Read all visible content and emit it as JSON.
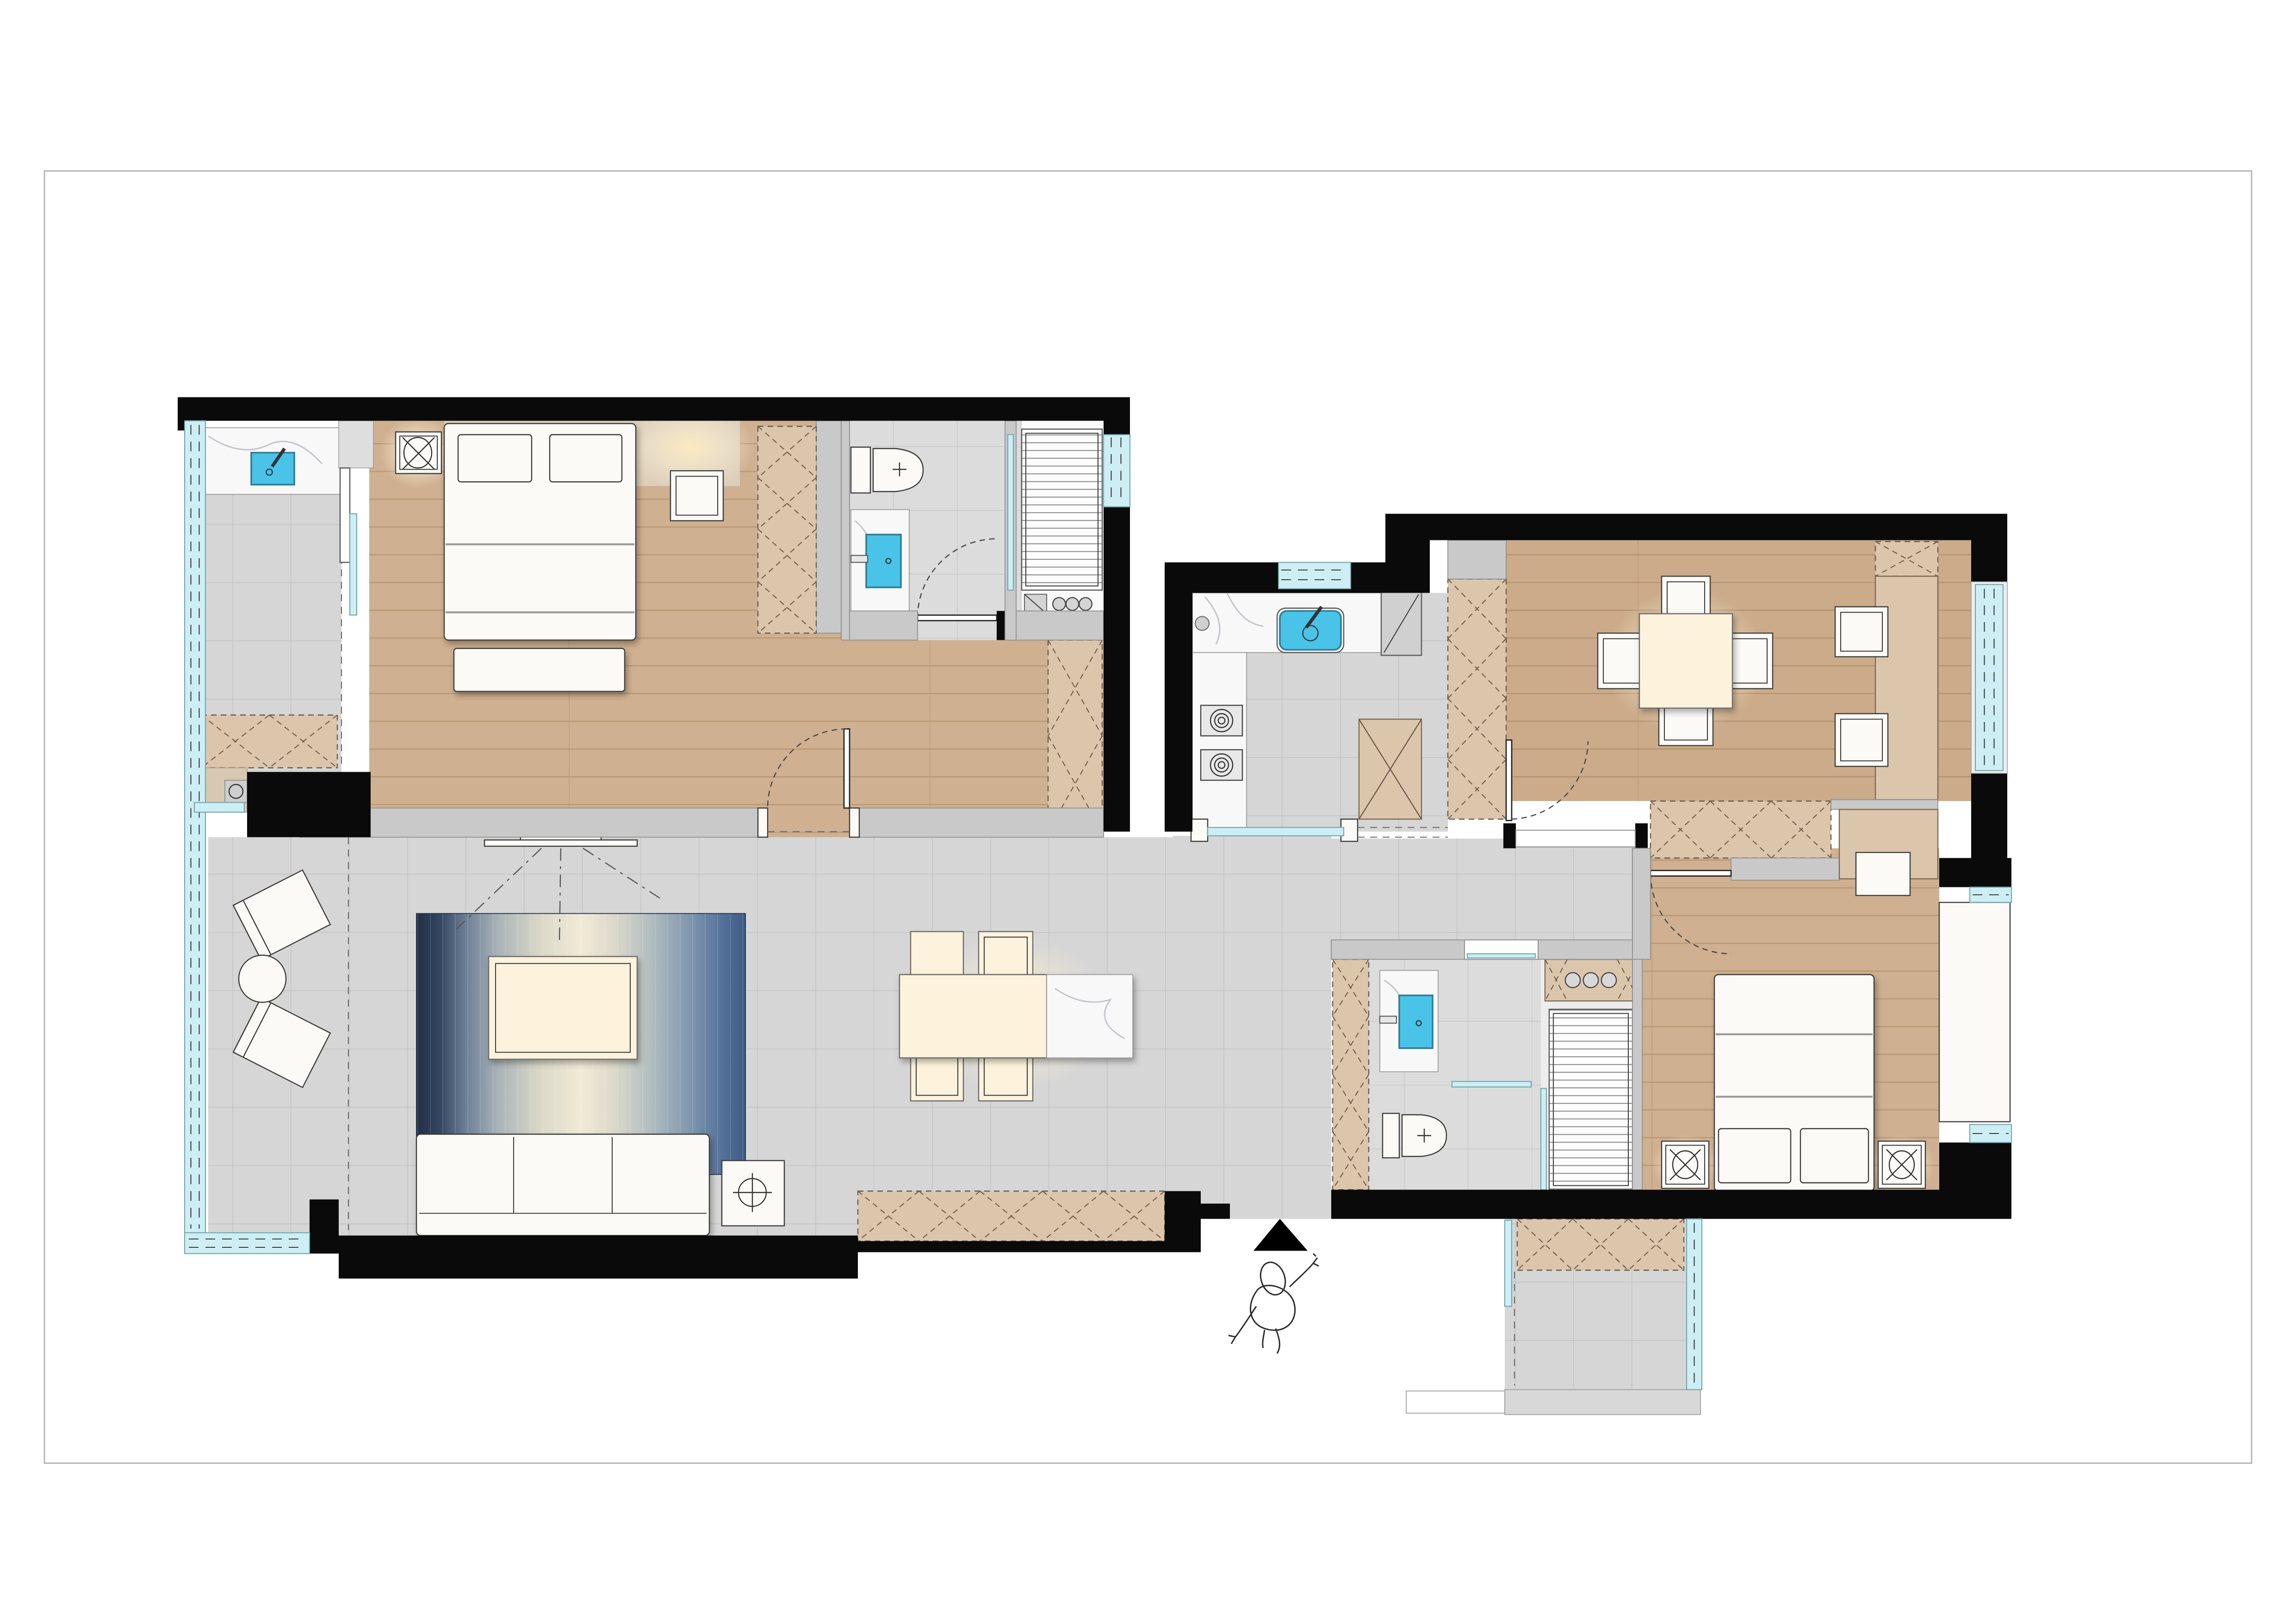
{
  "meta": {
    "type": "floor-plan",
    "view": "top-down rendered apartment plan",
    "scale_units": "none shown"
  },
  "colors": {
    "wall_black": "#0a0a0a",
    "wall_gray": "#c9c9c9",
    "wall_gray_border": "#8f8f8f",
    "wood": "#cfb090",
    "wood_line": "#b3926b",
    "tile": "#d6d6d6",
    "tile_line": "#bfbfbf",
    "marble": "#f8f8f8",
    "glass": "#cdeef4",
    "sink": "#4ac3e8",
    "cabinet": "#dbc6ac",
    "cream": "#fdf3dd",
    "furn": "#fbfaf7",
    "beige": "#ddcfba",
    "rug_dark": "#24304b",
    "rug_mid": "#8ba0b5",
    "rug_light": "#f0e9d6",
    "glow": "#fbedc4",
    "page_border": "#b5b5b5"
  },
  "rooms": [
    {
      "name": "bedroom-1",
      "floor": "wood",
      "furniture": [
        "double-bed",
        "two-pillows",
        "foot-bench",
        "nightstand",
        "ceiling-lamp",
        "wardrobe-column"
      ]
    },
    {
      "name": "laundry-balcony",
      "floor": "tile",
      "furniture": [
        "marble-counter",
        "laundry-sink",
        "storage-cabinet",
        "small-appliance"
      ]
    },
    {
      "name": "bathroom-1",
      "floor": "tile",
      "furniture": [
        "toilet",
        "marble-vanity",
        "basin",
        "swing-door",
        "glass-partition",
        "drying-rack",
        "water-heater"
      ]
    },
    {
      "name": "kitchen",
      "floor": "tile",
      "furniture": [
        "l-counter",
        "sink",
        "two-gas-burners",
        "fridge",
        "tall-cabinet",
        "sliding-door"
      ]
    },
    {
      "name": "dining-room",
      "floor": "wood",
      "furniture": [
        "square-table",
        "four-chairs",
        "wall-desk",
        "two-desk-chairs",
        "overhead-cabinet",
        "swing-door",
        "window"
      ]
    },
    {
      "name": "living-room",
      "floor": "tile",
      "furniture": [
        "sofa",
        "gradient-rug",
        "coffee-table",
        "tv",
        "tv-cabinet",
        "side-table-lamp",
        "dining-set-six"
      ]
    },
    {
      "name": "lounge-balcony",
      "floor": "tile",
      "furniture": [
        "two-angled-chairs",
        "round-table",
        "wrap-window"
      ]
    },
    {
      "name": "bathroom-2",
      "floor": "tile",
      "furniture": [
        "toilet",
        "marble-vanity",
        "basin",
        "glass-partition"
      ]
    },
    {
      "name": "laundry-closet",
      "floor": "tile",
      "furniture": [
        "washer-unit",
        "drying-rack",
        "storage-column"
      ]
    },
    {
      "name": "bedroom-2",
      "floor": "wood",
      "furniture": [
        "double-bed",
        "two-pillows",
        "two-nightstand-lamps",
        "corner-nightstand",
        "desk",
        "bay-window-bench",
        "overhead-cabinet",
        "swing-door"
      ]
    },
    {
      "name": "entry-porch",
      "floor": "tile",
      "furniture": [
        "shoe-cabinet",
        "side-windows",
        "entry-step"
      ]
    },
    {
      "name": "entrance",
      "floor": "none",
      "furniture": [
        "entry-arrow",
        "person-figure"
      ]
    }
  ]
}
